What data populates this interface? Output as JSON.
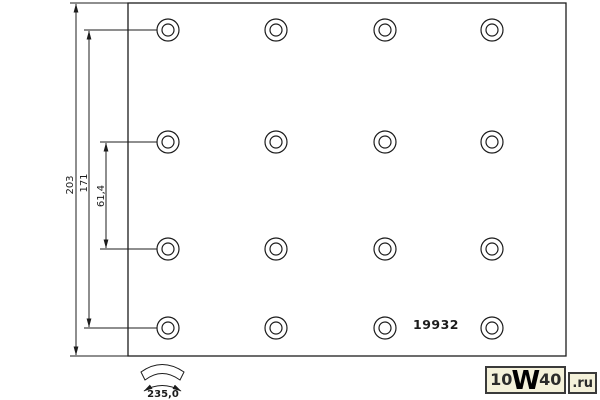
{
  "drawing": {
    "part_number_label": "19932",
    "dimensions": {
      "total_height": "203",
      "hole_span": "171",
      "hole_row_gap": "61,4",
      "arc_width": "235,0"
    },
    "hole_grid": {
      "cols_x": [
        168,
        276,
        385,
        492
      ],
      "rows_y": [
        30,
        142,
        249,
        328
      ],
      "outer_radius": 11,
      "inner_radius": 6
    },
    "line_color": "#1c1c1c"
  },
  "watermark": {
    "part1": "10",
    "part2": "W",
    "part3": "40",
    "part4": ".ru",
    "bg_color": "#f4f1da",
    "border_color": "#3a3a3a",
    "text_color": "#2b2b2b"
  }
}
